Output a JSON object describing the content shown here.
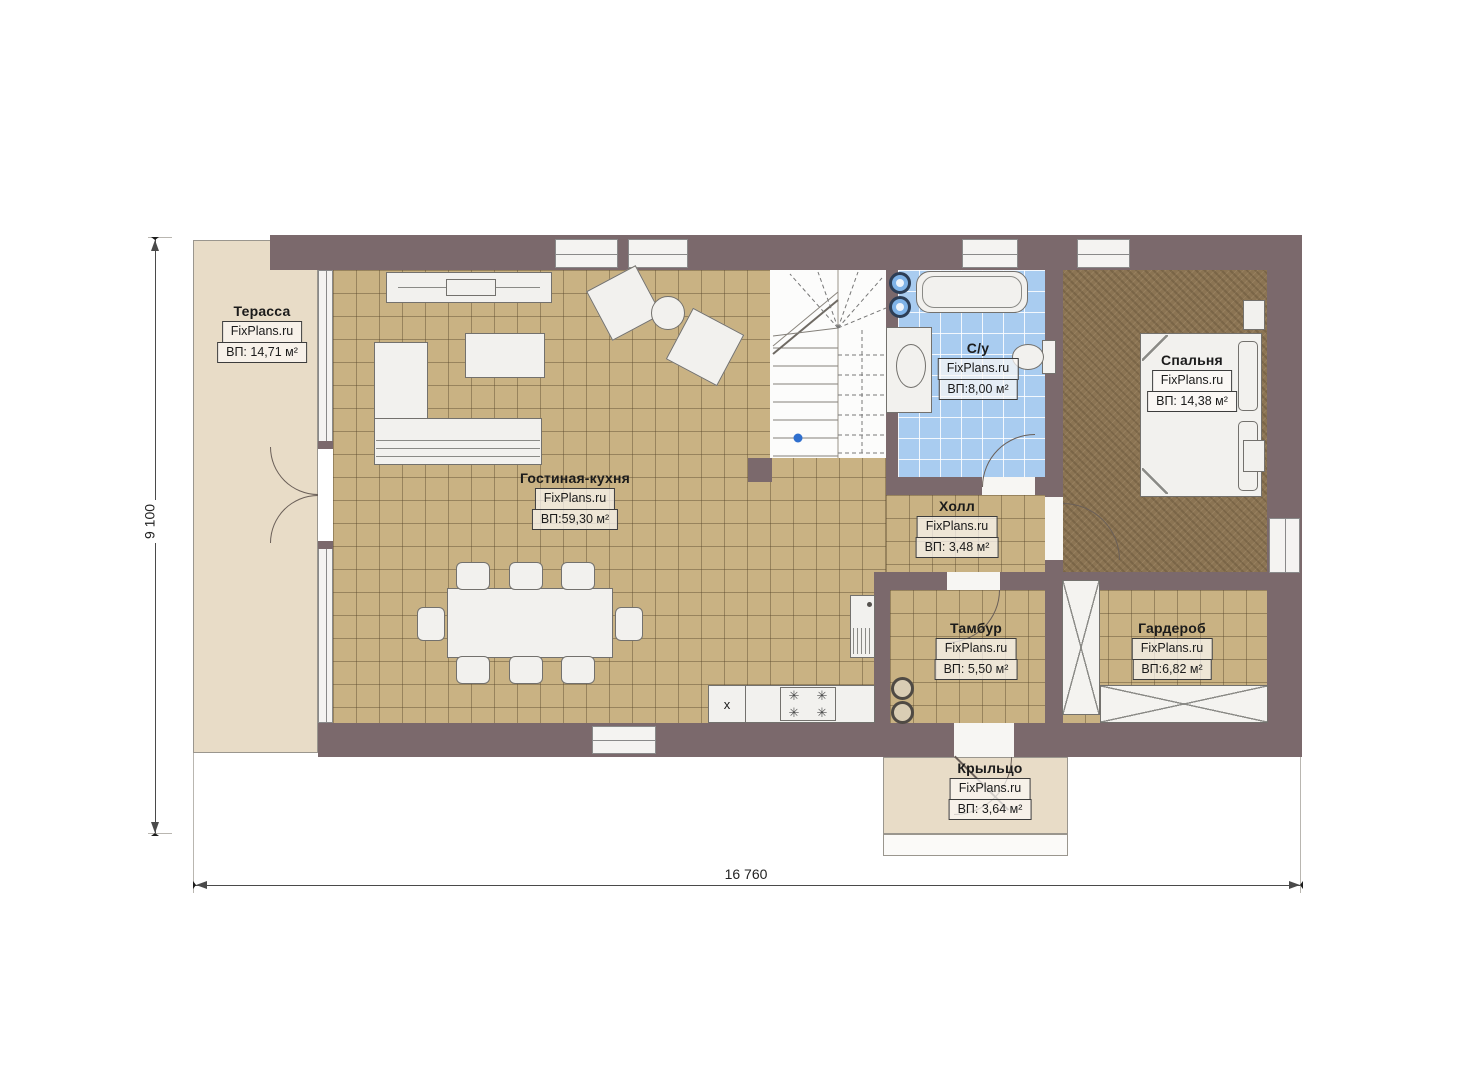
{
  "brand": "FixPlans.ru",
  "rooms": [
    {
      "id": "terrace",
      "name": "Терасса",
      "area": "ВП: 14,71 м²"
    },
    {
      "id": "living",
      "name": "Гостиная-кухня",
      "area": "ВП:59,30 м²"
    },
    {
      "id": "bath",
      "name": "С/у",
      "area": "ВП:8,00 м²"
    },
    {
      "id": "bedroom",
      "name": "Спальня",
      "area": "ВП: 14,38 м²"
    },
    {
      "id": "hall",
      "name": "Холл",
      "area": "ВП: 3,48 м²"
    },
    {
      "id": "tambur",
      "name": "Тамбур",
      "area": "ВП: 5,50 м²"
    },
    {
      "id": "wardrobe",
      "name": "Гардероб",
      "area": "ВП:6,82 м²"
    },
    {
      "id": "porch",
      "name": "Крыльцо",
      "area": "ВП: 3,64 м²"
    }
  ],
  "dimensions": {
    "width": "16 760",
    "height": "9 100"
  },
  "kitchen": {
    "x_marker": "x"
  },
  "icons": {
    "burner_glyph": "✳"
  },
  "colors": {
    "wall": "#7b696c",
    "tile_floor": "#c9b283",
    "bath_tile": "#a9ccf0",
    "bedroom_floor": "#8b7453",
    "terrace": "#e8dcc7",
    "stair_dot": "#2f6fce"
  }
}
